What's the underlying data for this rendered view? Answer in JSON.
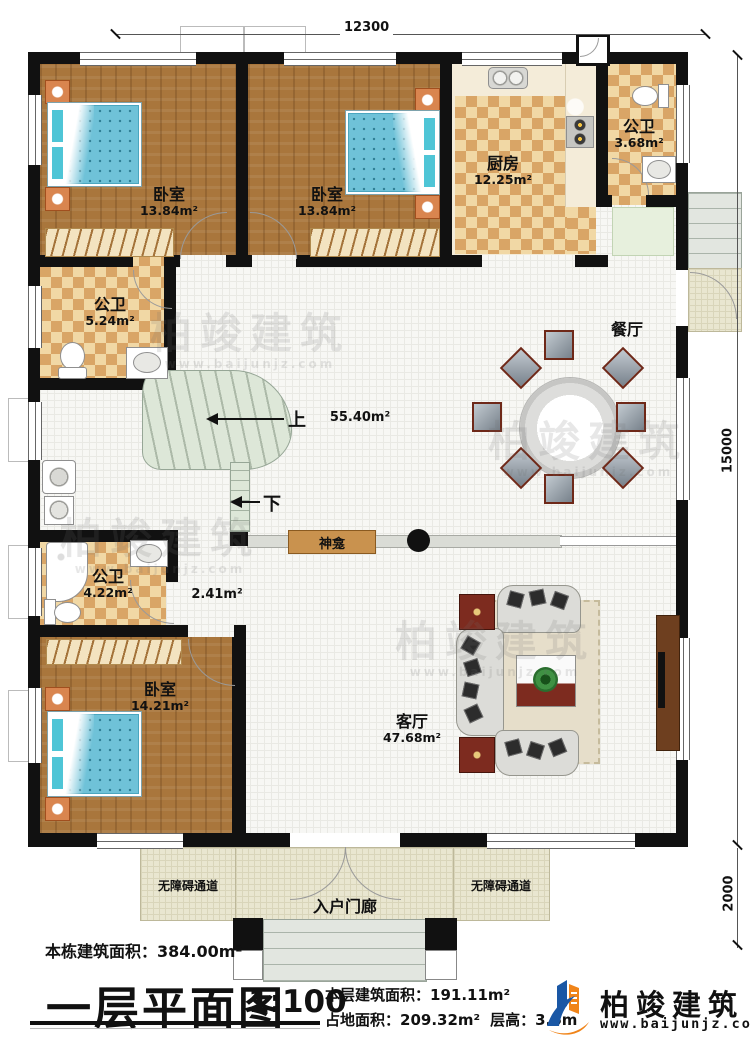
{
  "plan": {
    "dims": {
      "top": "12300",
      "right": "15000",
      "bottom_right": "2000"
    },
    "rooms": {
      "bedroom1": {
        "label": "卧室",
        "area": "13.84m²"
      },
      "bedroom2": {
        "label": "卧室",
        "area": "13.84m²"
      },
      "bedroom3": {
        "label": "卧室",
        "area": "14.21m²"
      },
      "kitchen": {
        "label": "厨房",
        "area": "12.25m²"
      },
      "bath_top": {
        "label": "公卫",
        "area": "3.68m²"
      },
      "bath_mid": {
        "label": "公卫",
        "area": "5.24m²"
      },
      "bath_low": {
        "label": "公卫",
        "area": "4.22m²"
      },
      "dining": {
        "label": "餐厅"
      },
      "living": {
        "label": "客厅",
        "area": "47.68m²"
      },
      "hall_area": "55.40m²",
      "corridor_area": "2.41m²",
      "porch": {
        "label": "入户门廊"
      },
      "ramp_left": {
        "label": "无障碍通道"
      },
      "ramp_right": {
        "label": "无障碍通道"
      }
    },
    "annotations": {
      "up": "上",
      "down": "下",
      "shrine": "神龛"
    }
  },
  "footer": {
    "building_area_label": "本栋建筑面积：",
    "building_area_value": "384.00m²",
    "title": "一层平面图",
    "scale": "1:100",
    "floor_area_label": "本层建筑面积：",
    "floor_area_value": "191.11m²",
    "land_area_label": "占地面积：",
    "land_area_value": "209.32m²",
    "height_label": "层高：",
    "height_value": "3.6m"
  },
  "logo": {
    "name": "柏竣建筑",
    "url": "www.baijunjz.com"
  },
  "watermark": {
    "text": "柏竣建筑",
    "url": "www.baijunjz.com"
  }
}
